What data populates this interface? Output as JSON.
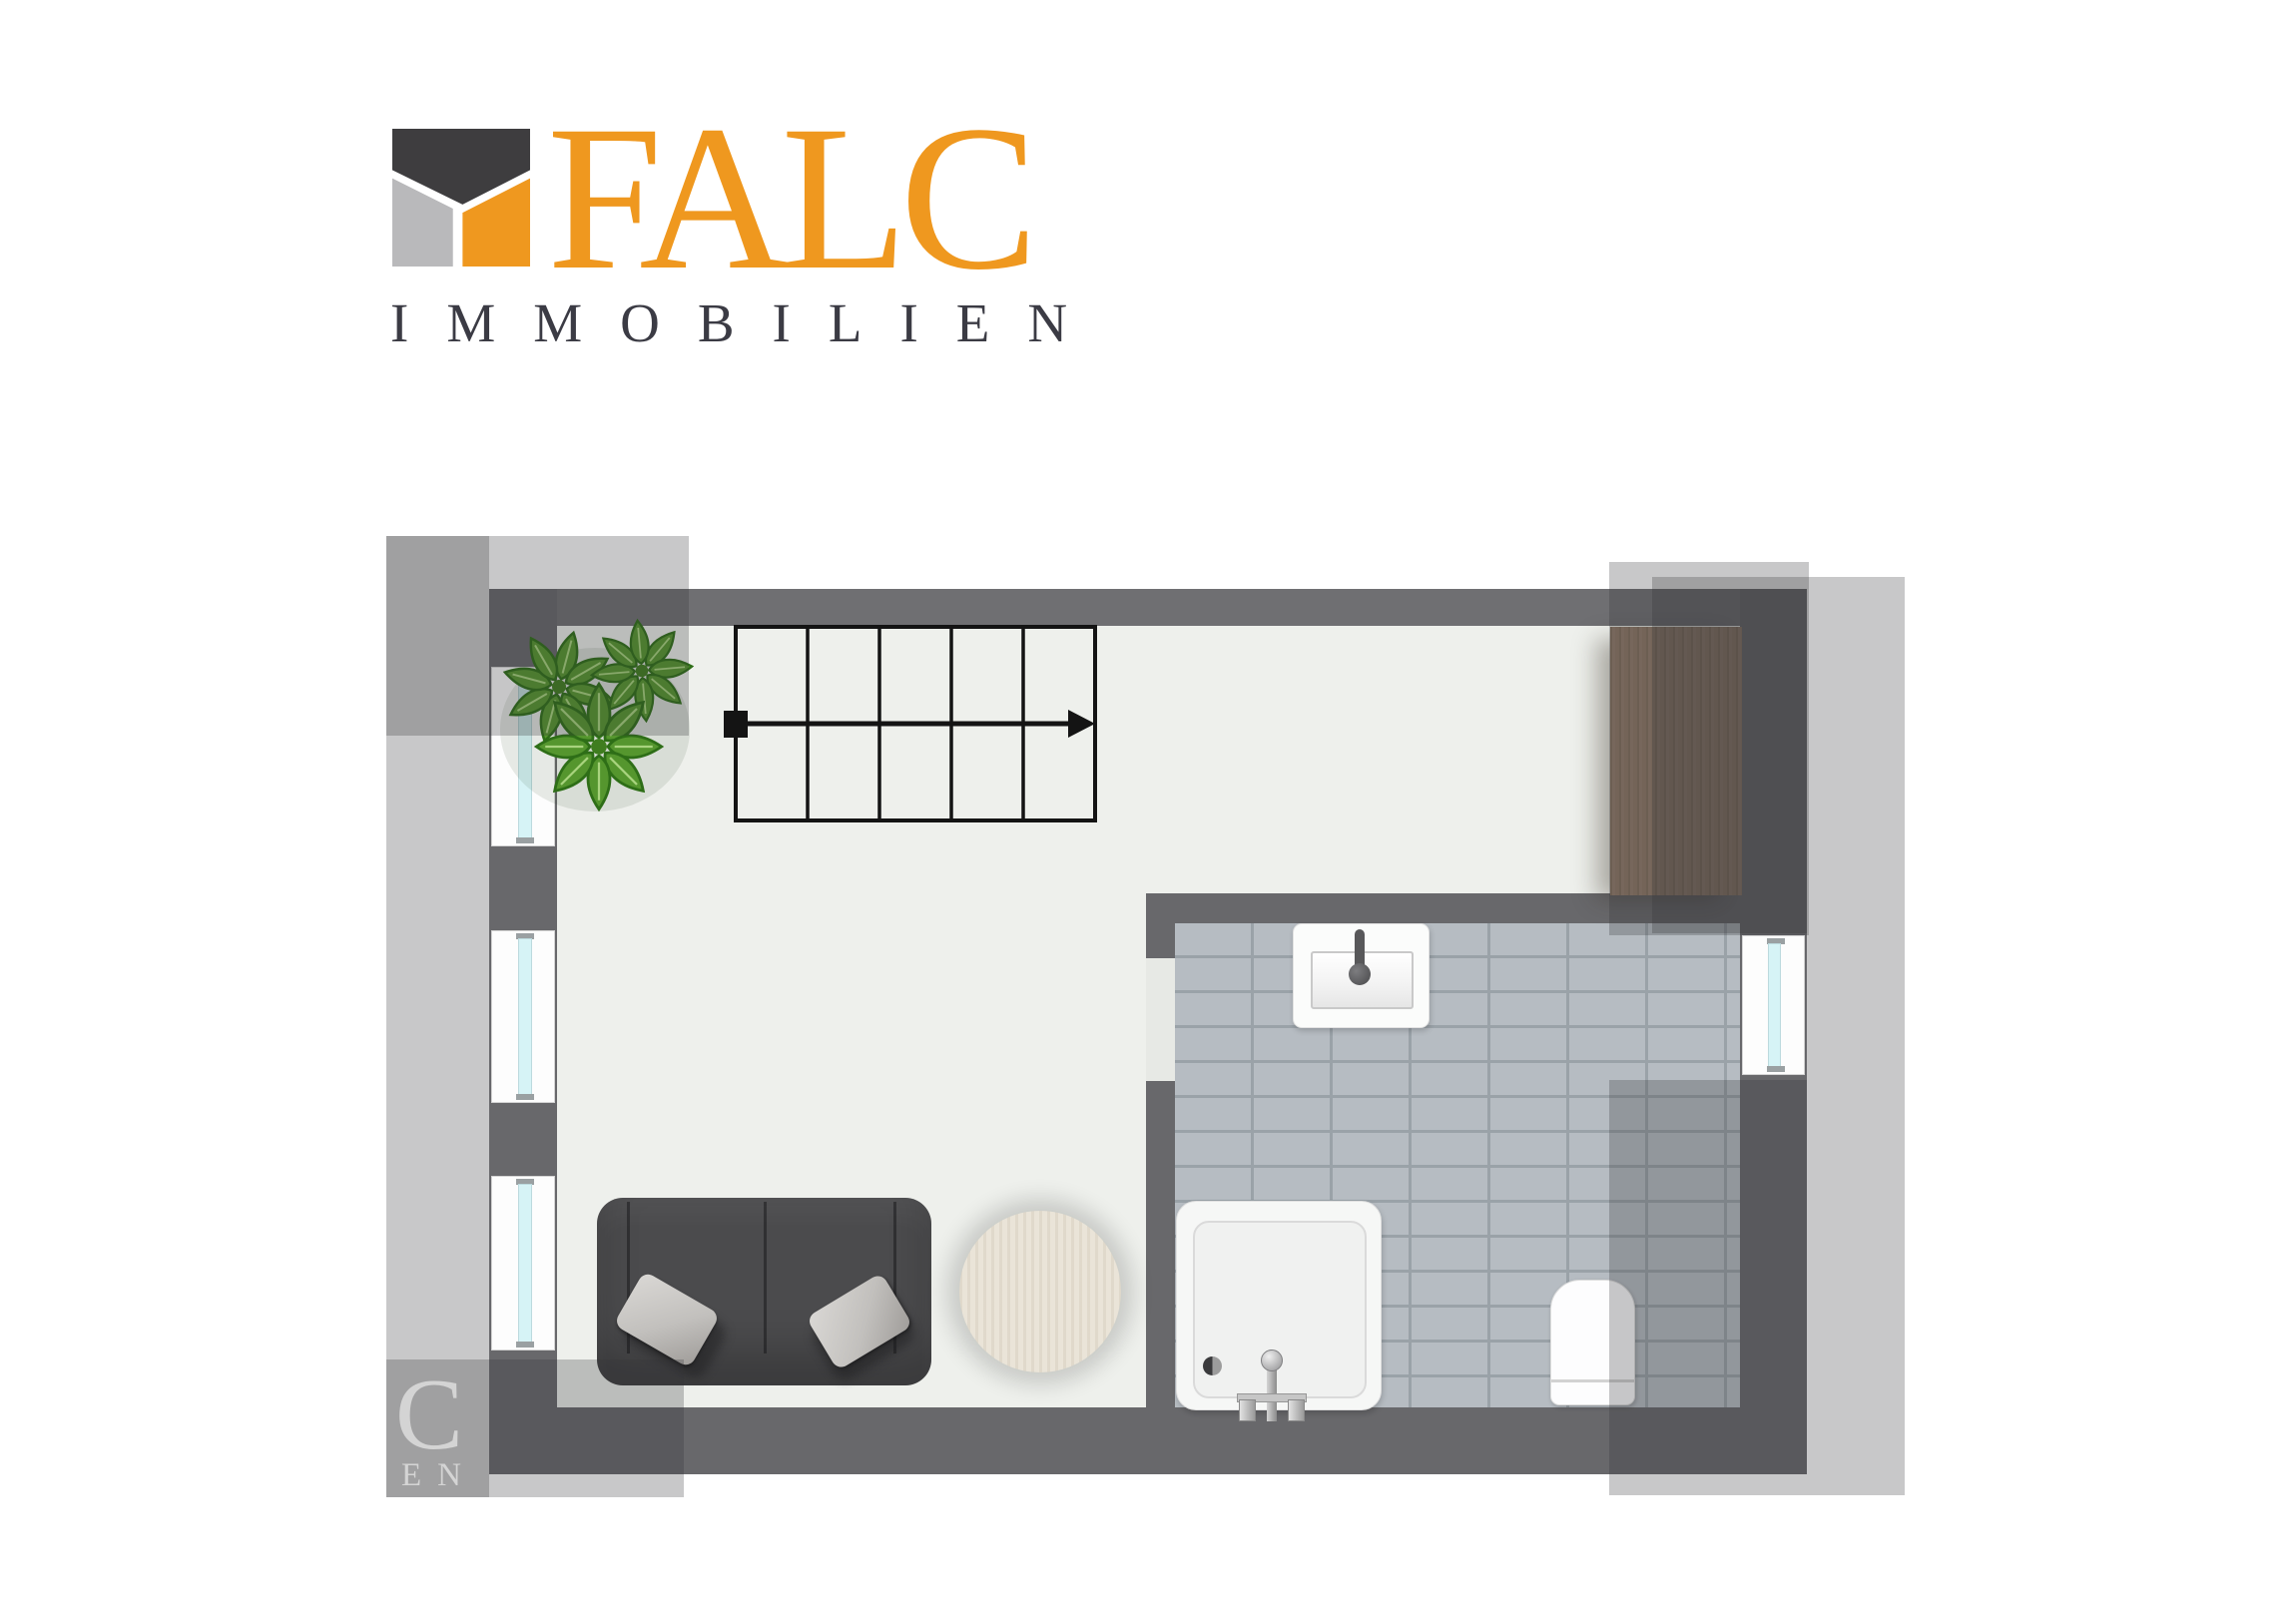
{
  "logo": {
    "brand": "FALC",
    "subtitle": "IMMOBILIEN"
  },
  "watermark": {
    "line1": "C",
    "line2": "EN"
  },
  "colors": {
    "page_bg": "#FFFFFF",
    "accent": "#EF981F",
    "logo_dark": "#3E3D3F",
    "logo_gray": "#B9B9BB",
    "subtitle": "#3B3B44",
    "wall": "#68686B",
    "wall_top": "#6F6F72",
    "floor": "#EEF0EC",
    "tile": "#B6BCC2",
    "tile_line": "#9AA2A8",
    "glass": "#D6F3F6",
    "glass_cap": "#9AA0A2",
    "stair_line": "#141414",
    "sofa": "#4B4B4D",
    "pillow": "#C9C7C4",
    "table": "#EAE4D8",
    "cabinet": "#8D7765",
    "plant_green": "#55962E",
    "overlay": "rgba(52,52,56,0.27)",
    "watermark_text": "rgba(255,255,255,0.55)"
  },
  "floorplan": {
    "stairs": {
      "steps": 5,
      "direction": "right"
    },
    "window_count": 4,
    "symbols": [
      "house-logo-icon",
      "plant-icon",
      "staircase-icon",
      "wardrobe-icon",
      "washbasin-icon",
      "shower-icon",
      "toilet-icon",
      "sofa-icon",
      "side-table-icon",
      "window-icon"
    ]
  }
}
